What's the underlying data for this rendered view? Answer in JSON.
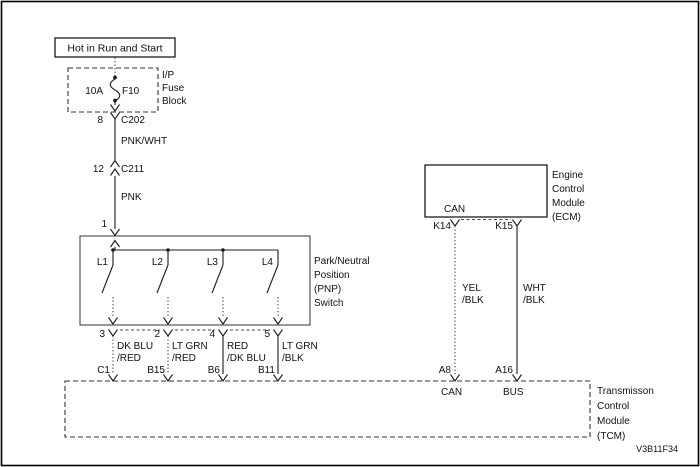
{
  "diagram": {
    "code": "V3B11F34",
    "power": {
      "source_label": "Hot in Run and Start",
      "fuse_amp": "10A",
      "fuse_name": "F10",
      "fuse_block_label": [
        "I/P",
        "Fuse",
        "Block"
      ],
      "pin_8": "8",
      "conn_c202": "C202",
      "wire_pnk_wht": "PNK/WHT",
      "pin_12": "12",
      "conn_c211": "C211",
      "wire_pnk": "PNK",
      "pin_1": "1"
    },
    "pnp_switch": {
      "label": [
        "Park/Neutral",
        "Position",
        "(PNP)",
        "Switch"
      ],
      "switches": [
        "L1",
        "L2",
        "L3",
        "L4"
      ],
      "out_pins": [
        "3",
        "2",
        "4",
        "5"
      ],
      "wires": [
        {
          "color1": "DK BLU",
          "color2": "/RED",
          "tcm_pin": "C1"
        },
        {
          "color1": "LT GRN",
          "color2": "/RED",
          "tcm_pin": "B15"
        },
        {
          "color1": "RED",
          "color2": "/DK BLU",
          "tcm_pin": "B6"
        },
        {
          "color1": "LT GRN",
          "color2": "/BLK",
          "tcm_pin": "B11"
        }
      ]
    },
    "ecm": {
      "label": [
        "Engine",
        "Control",
        "Module",
        "(ECM)"
      ],
      "internal_label": "CAN",
      "pins": [
        "K14",
        "K15"
      ],
      "wires": [
        {
          "color1": "YEL",
          "color2": "/BLK",
          "tcm_pin": "A8",
          "tcm_label": "CAN"
        },
        {
          "color1": "WHT",
          "color2": "/BLK",
          "tcm_pin": "A16",
          "tcm_label": "BUS"
        }
      ]
    },
    "tcm": {
      "label": [
        "Transmisson",
        "Control",
        "Module",
        "(TCM)"
      ]
    },
    "colors": {
      "line": "#1a1a1a",
      "background": "#ffffff"
    }
  }
}
